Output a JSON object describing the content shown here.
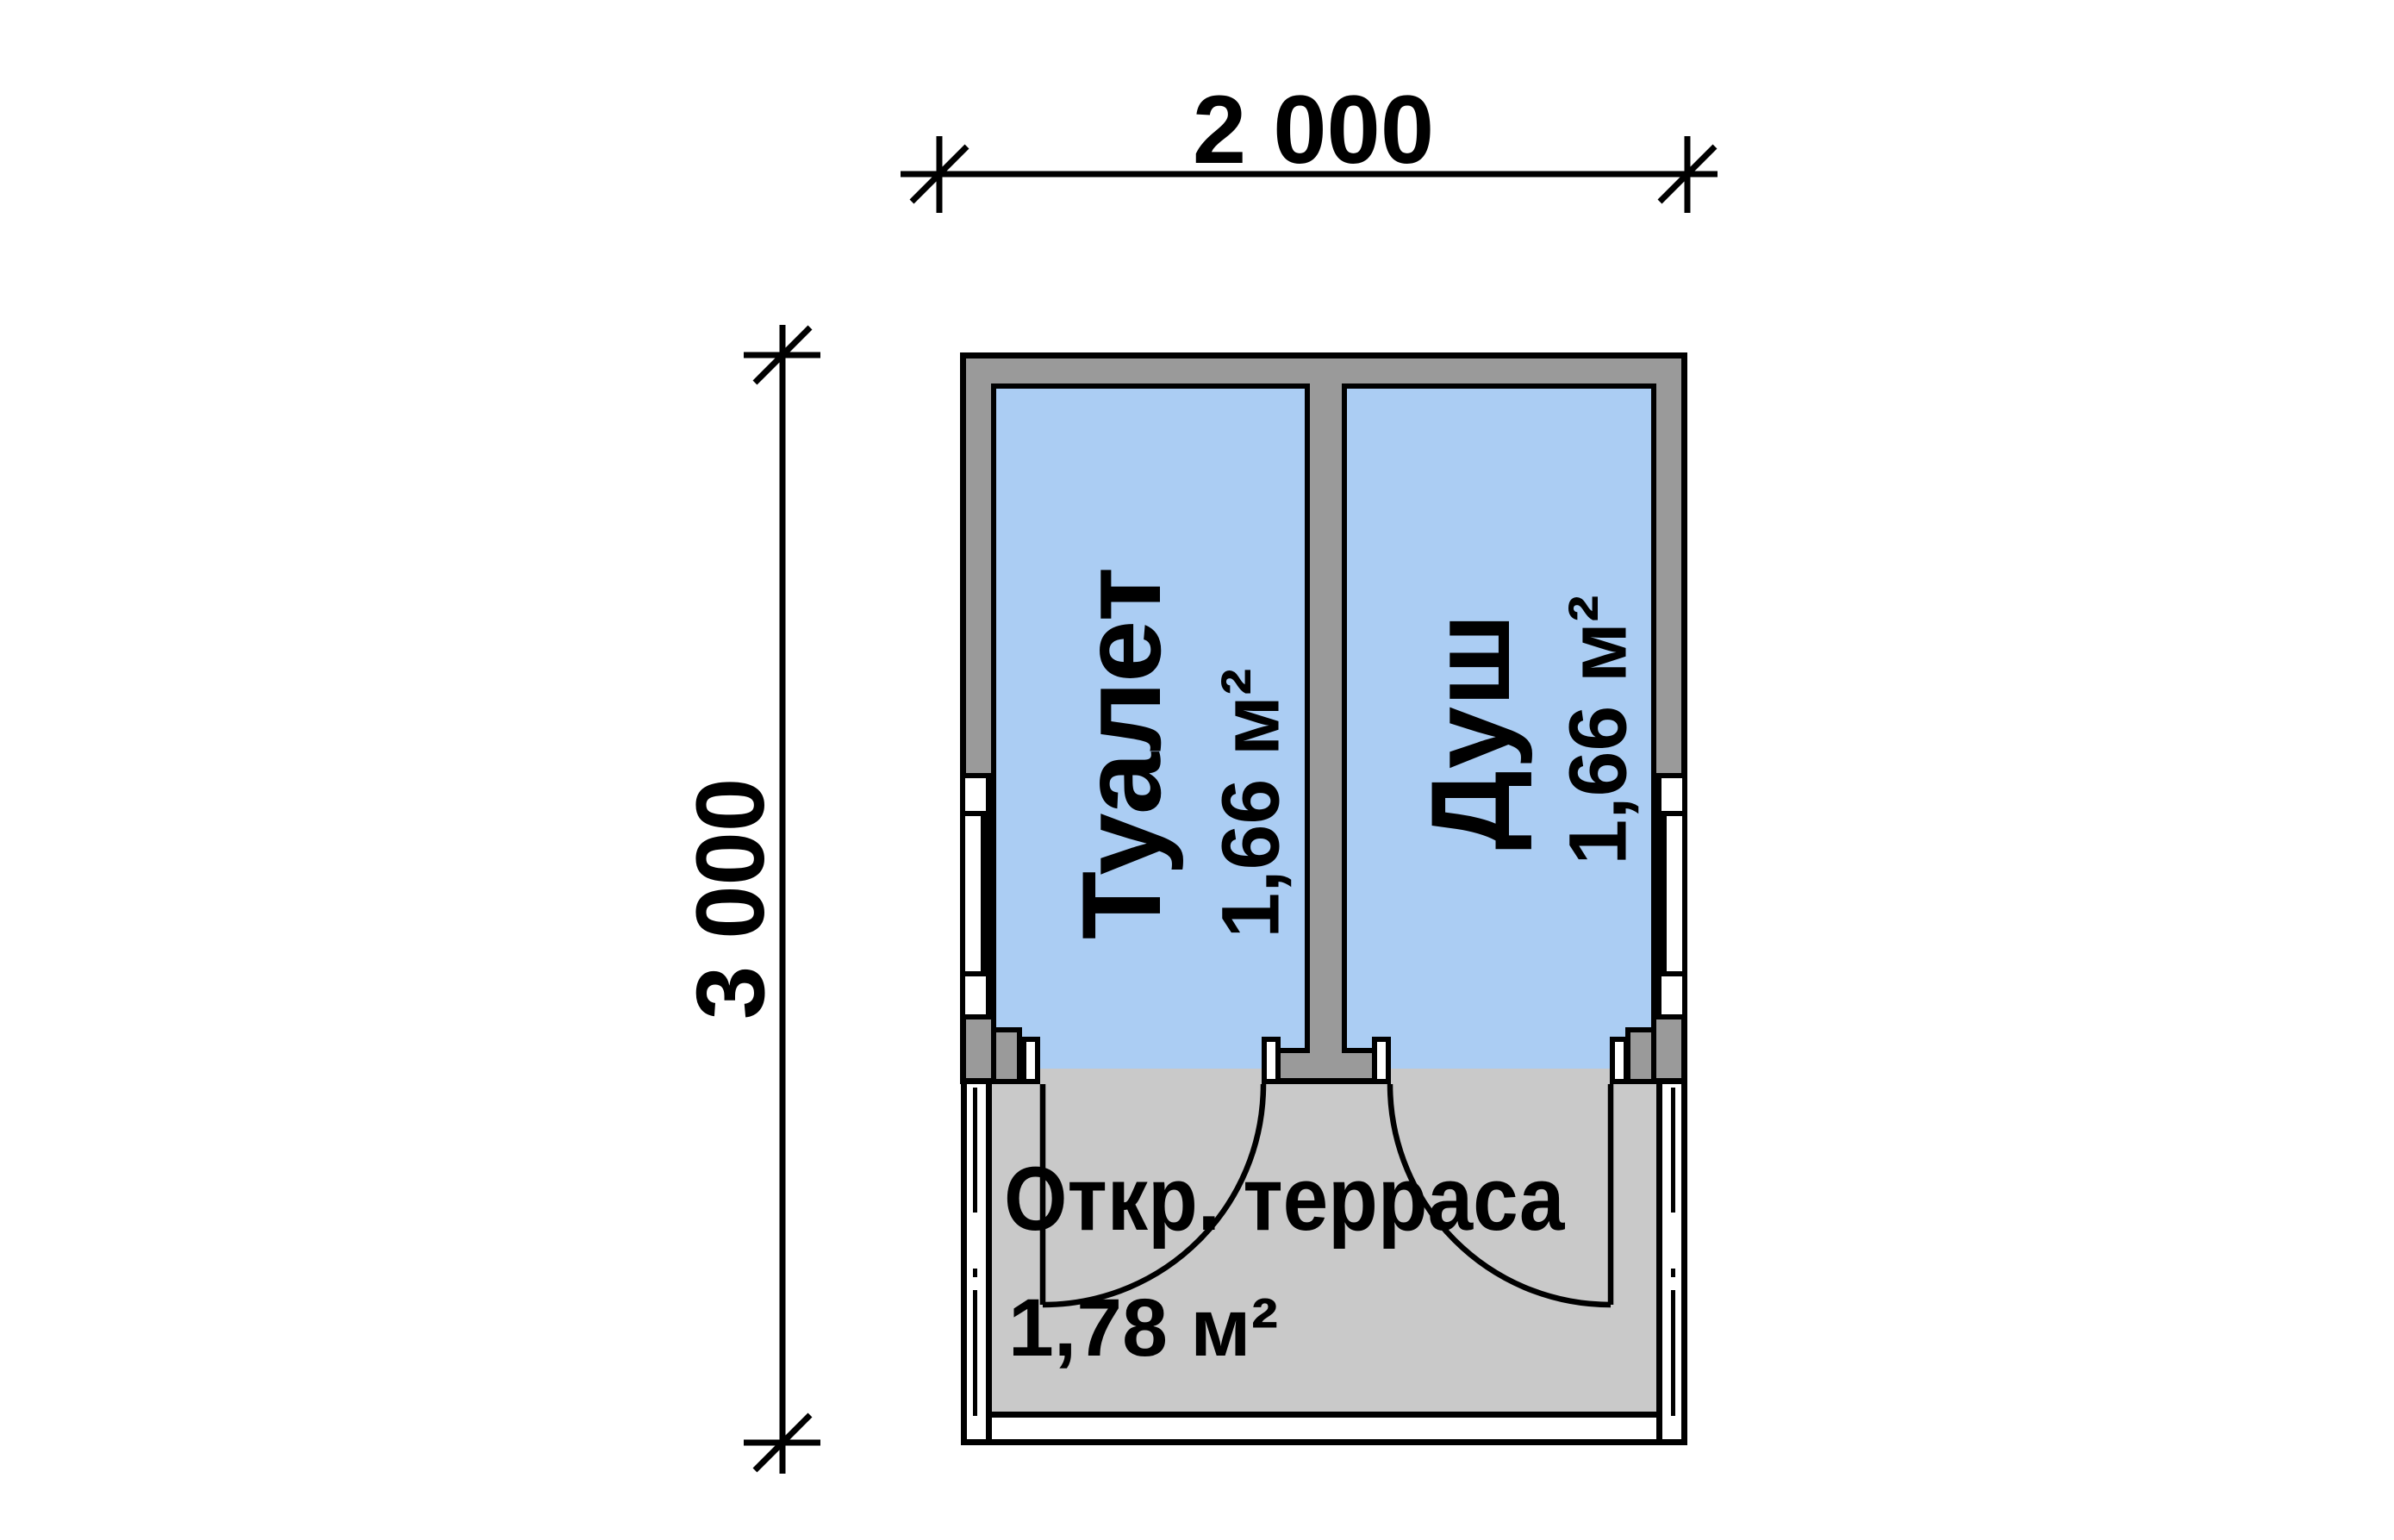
{
  "drawing": {
    "type": "floor-plan",
    "dimensions": {
      "width_label": "2 000",
      "height_label": "3 000"
    },
    "rooms": [
      {
        "name": "Туалет",
        "area": "1,66 м²"
      },
      {
        "name": "Душ",
        "area": "1,66 м²"
      }
    ],
    "terrace": {
      "name": "Откр. терраса",
      "area": "1,78 м²"
    },
    "colors": {
      "room_fill": "#abcdf3",
      "wall_fill": "#9a9a9a",
      "terrace_fill": "#c9c9c9",
      "line": "#000000",
      "background": "#ffffff"
    }
  }
}
